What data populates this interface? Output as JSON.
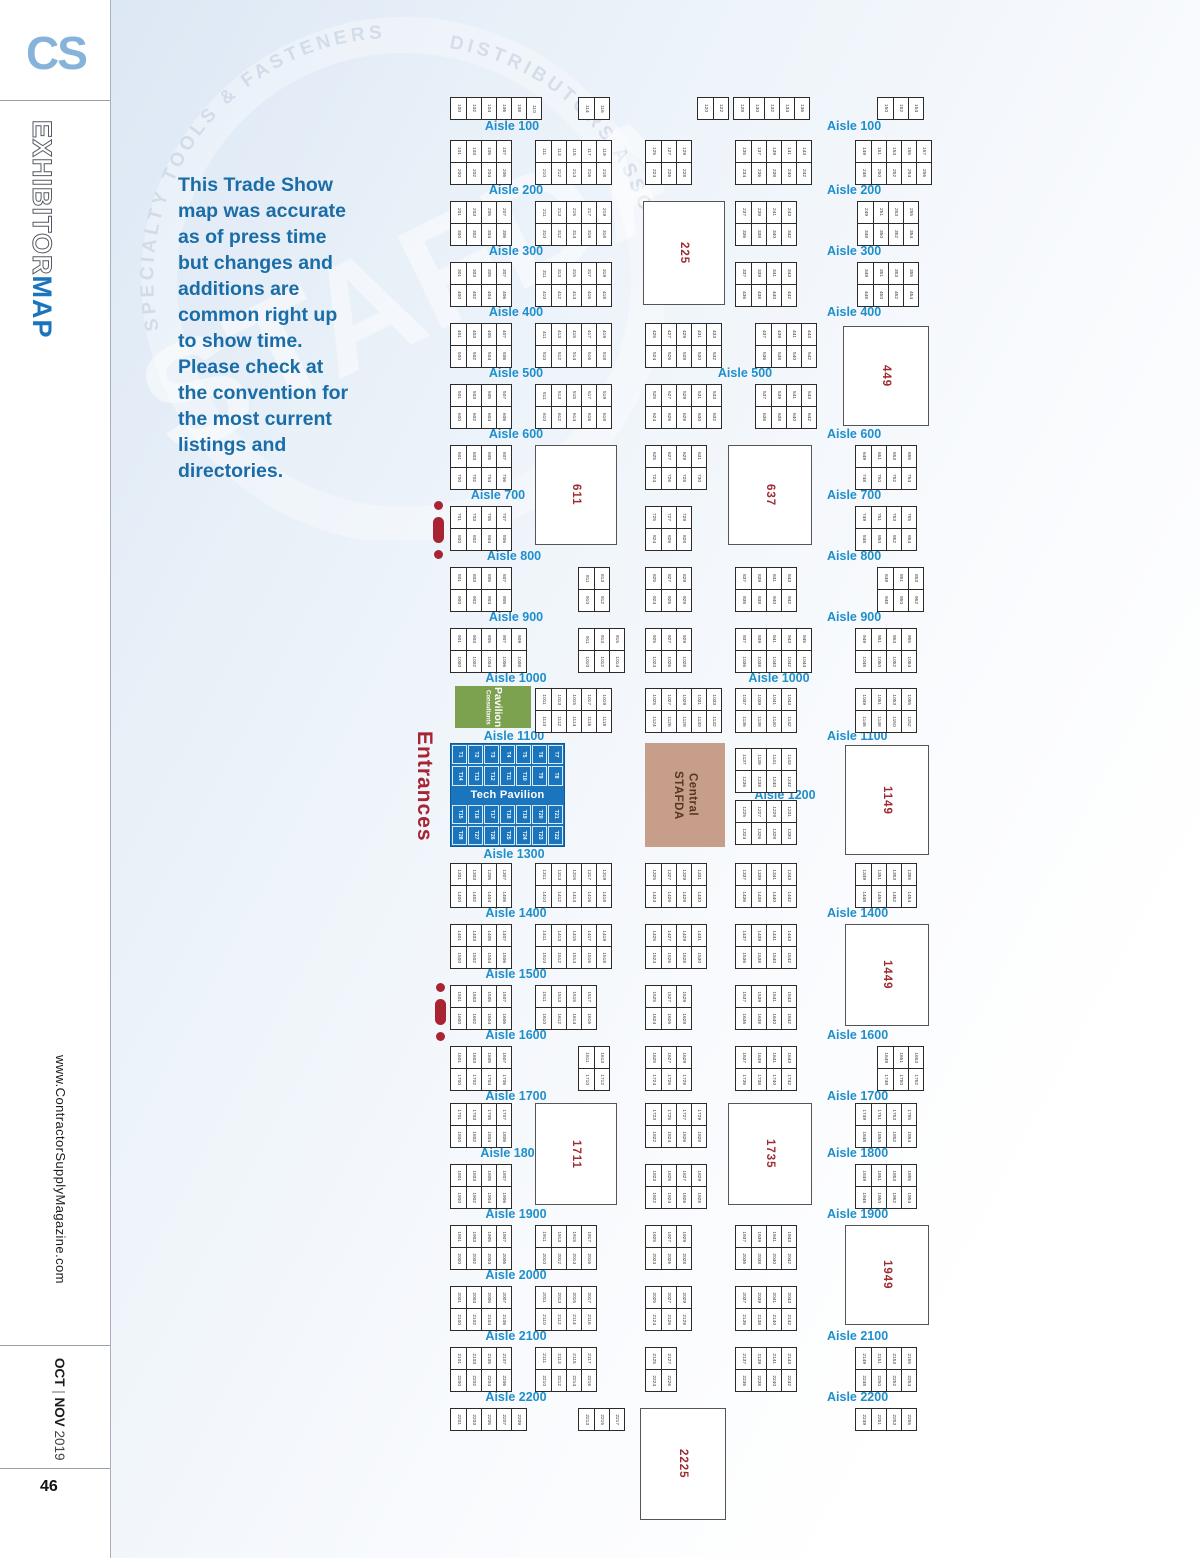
{
  "sidebar": {
    "logo": "CS",
    "masthead_light": "EXHIBITOR",
    "masthead_bold": "MAP",
    "website": "www.ContractorSupplyMagazine.com",
    "issue_month1": "OCT",
    "issue_sep": " | ",
    "issue_month2": "NOV",
    "issue_year": " 2019",
    "page_number": "46"
  },
  "intro": "This Trade Show\nmap was accurate\nas of press time\nbut changes and\nadditions are\ncommon right up\nto show time.\nPlease check at\nthe convention for\nthe most current\nlistings and\ndirectories.",
  "watermark": {
    "arc_left": "SPECIALTY TOOLS & FASTENERS",
    "arc_right": "DISTRIBUTORS ASSOCIATION",
    "ghost": "STAFDA"
  },
  "colors": {
    "aisle_label": "#1e8fcc",
    "booth_number_red": "#9e2b30",
    "entrance_red": "#a82433",
    "tech_blue": "#1a75bc",
    "pavilion_green": "#7ca24f",
    "stafda_tan": "#c79e8a",
    "intro_blue": "#1a6da7",
    "logo_blue": "#85b3da"
  },
  "map": {
    "entrances": "Entrances",
    "zones": {
      "consultants": {
        "line1": "Consultants",
        "line2": "Pavilion"
      },
      "stafda": {
        "line1": "STAFDA",
        "line2": "Central"
      },
      "tech": {
        "title": "Tech Pavilion",
        "rows": [
          [
            "T1",
            "T2",
            "T3",
            "T4",
            "T5",
            "T6",
            "T7"
          ],
          [
            "T14",
            "T13",
            "T12",
            "T11",
            "T10",
            "T9",
            "T8"
          ],
          [
            "T15",
            "T16",
            "T17",
            "T18",
            "T19",
            "T20",
            "T21"
          ],
          [
            "T28",
            "T27",
            "T26",
            "T25",
            "T24",
            "T23",
            "T22"
          ]
        ]
      }
    },
    "labels": [
      {
        "t": "Aisle 100",
        "x": 512,
        "y": 119,
        "a": "c"
      },
      {
        "t": "Aisle 200",
        "x": 516,
        "y": 183,
        "a": "c"
      },
      {
        "t": "Aisle 300",
        "x": 516,
        "y": 244,
        "a": "c"
      },
      {
        "t": "Aisle 400",
        "x": 516,
        "y": 305,
        "a": "c"
      },
      {
        "t": "Aisle 500",
        "x": 516,
        "y": 366,
        "a": "c"
      },
      {
        "t": "Aisle 600",
        "x": 516,
        "y": 427,
        "a": "c"
      },
      {
        "t": "Aisle 700",
        "x": 498,
        "y": 488,
        "a": "c"
      },
      {
        "t": "Aisle 800",
        "x": 514,
        "y": 549,
        "a": "c"
      },
      {
        "t": "Aisle 900",
        "x": 516,
        "y": 610,
        "a": "c"
      },
      {
        "t": "Aisle 1000",
        "x": 516,
        "y": 671,
        "a": "c"
      },
      {
        "t": "Aisle 1100",
        "x": 514,
        "y": 729,
        "a": "c"
      },
      {
        "t": "Aisle 1300",
        "x": 514,
        "y": 847,
        "a": "c"
      },
      {
        "t": "Aisle 1400",
        "x": 516,
        "y": 906,
        "a": "c"
      },
      {
        "t": "Aisle 1500",
        "x": 516,
        "y": 967,
        "a": "c"
      },
      {
        "t": "Aisle 1600",
        "x": 516,
        "y": 1028,
        "a": "c"
      },
      {
        "t": "Aisle 1700",
        "x": 516,
        "y": 1089,
        "a": "c"
      },
      {
        "t": "Aisle 1800",
        "x": 511,
        "y": 1146,
        "a": "c"
      },
      {
        "t": "Aisle 1900",
        "x": 516,
        "y": 1207,
        "a": "c"
      },
      {
        "t": "Aisle 2000",
        "x": 516,
        "y": 1268,
        "a": "c"
      },
      {
        "t": "Aisle 2100",
        "x": 516,
        "y": 1329,
        "a": "c"
      },
      {
        "t": "Aisle 2200",
        "x": 516,
        "y": 1390,
        "a": "c"
      },
      {
        "t": "Aisle 500",
        "x": 745,
        "y": 366,
        "a": "c"
      },
      {
        "t": "Aisle 1000",
        "x": 779,
        "y": 671,
        "a": "c"
      },
      {
        "t": "Aisle 1200",
        "x": 785,
        "y": 788,
        "a": "c"
      },
      {
        "t": "Aisle 100",
        "x": 827,
        "y": 119,
        "a": "l"
      },
      {
        "t": "Aisle 200",
        "x": 827,
        "y": 183,
        "a": "l"
      },
      {
        "t": "Aisle 300",
        "x": 827,
        "y": 244,
        "a": "l"
      },
      {
        "t": "Aisle 400",
        "x": 827,
        "y": 305,
        "a": "l"
      },
      {
        "t": "Aisle 600",
        "x": 827,
        "y": 427,
        "a": "l"
      },
      {
        "t": "Aisle 700",
        "x": 827,
        "y": 488,
        "a": "l"
      },
      {
        "t": "Aisle 800",
        "x": 827,
        "y": 549,
        "a": "l"
      },
      {
        "t": "Aisle 900",
        "x": 827,
        "y": 610,
        "a": "l"
      },
      {
        "t": "Aisle 1100",
        "x": 827,
        "y": 729,
        "a": "l"
      },
      {
        "t": "Aisle 1400",
        "x": 827,
        "y": 906,
        "a": "l"
      },
      {
        "t": "Aisle 1600",
        "x": 827,
        "y": 1028,
        "a": "l"
      },
      {
        "t": "Aisle 1700",
        "x": 827,
        "y": 1089,
        "a": "l"
      },
      {
        "t": "Aisle 1800",
        "x": 827,
        "y": 1146,
        "a": "l"
      },
      {
        "t": "Aisle 1900",
        "x": 827,
        "y": 1207,
        "a": "l"
      },
      {
        "t": "Aisle 2100",
        "x": 827,
        "y": 1329,
        "a": "l"
      },
      {
        "t": "Aisle 2200",
        "x": 827,
        "y": 1390,
        "a": "l"
      }
    ],
    "big_booths": [
      {
        "n": "225",
        "x": 643,
        "y": 201,
        "w": 82,
        "h": 104
      },
      {
        "n": "449",
        "x": 843,
        "y": 326,
        "w": 86,
        "h": 100
      },
      {
        "n": "611",
        "x": 535,
        "y": 445,
        "w": 82,
        "h": 100
      },
      {
        "n": "637",
        "x": 728,
        "y": 445,
        "w": 84,
        "h": 100
      },
      {
        "n": "1149",
        "x": 845,
        "y": 745,
        "w": 84,
        "h": 110
      },
      {
        "n": "1449",
        "x": 845,
        "y": 924,
        "w": 84,
        "h": 102
      },
      {
        "n": "1711",
        "x": 535,
        "y": 1103,
        "w": 82,
        "h": 102
      },
      {
        "n": "1735",
        "x": 728,
        "y": 1103,
        "w": 84,
        "h": 102
      },
      {
        "n": "1949",
        "x": 845,
        "y": 1225,
        "w": 84,
        "h": 100
      },
      {
        "n": "2225",
        "x": 640,
        "y": 1408,
        "w": 86,
        "h": 112
      }
    ],
    "strips": [
      {
        "y": 97,
        "blocks": [
          {
            "x": 450,
            "c": 6,
            "s": 100
          },
          {
            "x": 578,
            "c": 2,
            "s": 114
          },
          {
            "x": 697,
            "c": 2,
            "s": 120
          },
          {
            "x": 733,
            "c": 5,
            "s": 128
          },
          {
            "x": 877,
            "c": 3,
            "s": 150
          }
        ]
      },
      {
        "y": 140,
        "blocks": [
          {
            "x": 450,
            "c": 4,
            "t": 101,
            "b": 200
          },
          {
            "x": 535,
            "c": 5,
            "t": 111,
            "b": 210
          },
          {
            "x": 645,
            "c": 3,
            "t": 125,
            "b": 224
          },
          {
            "x": 735,
            "c": 5,
            "t": 135,
            "b": 234
          },
          {
            "x": 855,
            "c": 5,
            "t": 149,
            "b": 248
          }
        ]
      },
      {
        "y": 201,
        "blocks": [
          {
            "x": 450,
            "c": 4,
            "t": 201,
            "b": 300
          },
          {
            "x": 535,
            "c": 5,
            "t": 211,
            "b": 310
          },
          {
            "x": 735,
            "c": 4,
            "t": 237,
            "b": 336
          },
          {
            "x": 857,
            "c": 4,
            "t": 249,
            "b": 348
          }
        ]
      },
      {
        "y": 262,
        "blocks": [
          {
            "x": 450,
            "c": 4,
            "t": 301,
            "b": 400
          },
          {
            "x": 535,
            "c": 5,
            "t": 311,
            "b": 410
          },
          {
            "x": 735,
            "c": 4,
            "t": 337,
            "b": 436
          },
          {
            "x": 857,
            "c": 4,
            "t": 349,
            "b": 448
          }
        ]
      },
      {
        "y": 323,
        "blocks": [
          {
            "x": 450,
            "c": 4,
            "t": 401,
            "b": 500
          },
          {
            "x": 535,
            "c": 5,
            "t": 411,
            "b": 510
          },
          {
            "x": 645,
            "c": 5,
            "t": 425,
            "b": 524
          },
          {
            "x": 755,
            "c": 4,
            "t": 437,
            "b": 536
          }
        ]
      },
      {
        "y": 384,
        "blocks": [
          {
            "x": 450,
            "c": 4,
            "t": 501,
            "b": 600
          },
          {
            "x": 535,
            "c": 5,
            "t": 511,
            "b": 610
          },
          {
            "x": 645,
            "c": 5,
            "t": 525,
            "b": 624
          },
          {
            "x": 755,
            "c": 4,
            "t": 537,
            "b": 636
          }
        ]
      },
      {
        "y": 445,
        "blocks": [
          {
            "x": 450,
            "c": 4,
            "t": 601,
            "b": 700
          },
          {
            "x": 645,
            "c": 4,
            "t": 625,
            "b": 724
          },
          {
            "x": 855,
            "c": 4,
            "t": 649,
            "b": 748
          }
        ]
      },
      {
        "y": 506,
        "blocks": [
          {
            "x": 450,
            "c": 4,
            "t": 701,
            "b": 800
          },
          {
            "x": 645,
            "c": 3,
            "t": 725,
            "b": 824
          },
          {
            "x": 855,
            "c": 4,
            "t": 749,
            "b": 848
          }
        ]
      },
      {
        "y": 567,
        "blocks": [
          {
            "x": 450,
            "c": 4,
            "t": 801,
            "b": 900
          },
          {
            "x": 578,
            "c": 2,
            "t": 811,
            "b": 910
          },
          {
            "x": 645,
            "c": 3,
            "t": 825,
            "b": 924
          },
          {
            "x": 735,
            "c": 4,
            "t": 837,
            "b": 936
          },
          {
            "x": 877,
            "c": 3,
            "t": 849,
            "b": 948
          }
        ]
      },
      {
        "y": 628,
        "blocks": [
          {
            "x": 450,
            "c": 5,
            "t": 901,
            "b": 1000
          },
          {
            "x": 578,
            "c": 3,
            "t": 911,
            "b": 1010
          },
          {
            "x": 645,
            "c": 3,
            "t": 925,
            "b": 1024
          },
          {
            "x": 735,
            "c": 5,
            "t": 937,
            "b": 1036
          },
          {
            "x": 855,
            "c": 4,
            "t": 949,
            "b": 1048
          }
        ]
      },
      {
        "y": 688,
        "blocks": [
          {
            "x": 535,
            "c": 5,
            "t": 1011,
            "b": 1110
          },
          {
            "x": 645,
            "c": 5,
            "t": 1025,
            "b": 1124
          },
          {
            "x": 735,
            "c": 4,
            "t": 1037,
            "b": 1136
          },
          {
            "x": 855,
            "c": 4,
            "t": 1049,
            "b": 1146
          }
        ]
      },
      {
        "y": 748,
        "blocks": [
          {
            "x": 735,
            "c": 4,
            "t": 1137,
            "b": 1236
          }
        ]
      },
      {
        "y": 800,
        "blocks": [
          {
            "x": 735,
            "c": 4,
            "t": 1225,
            "b": 1324
          }
        ]
      },
      {
        "y": 863,
        "blocks": [
          {
            "x": 450,
            "c": 4,
            "t": 1301,
            "b": 1400
          },
          {
            "x": 535,
            "c": 5,
            "t": 1311,
            "b": 1410
          },
          {
            "x": 645,
            "c": 4,
            "t": 1325,
            "b": 1424
          },
          {
            "x": 735,
            "c": 4,
            "t": 1337,
            "b": 1436
          },
          {
            "x": 855,
            "c": 4,
            "t": 1349,
            "b": 1448
          }
        ]
      },
      {
        "y": 924,
        "blocks": [
          {
            "x": 450,
            "c": 4,
            "t": 1401,
            "b": 1500
          },
          {
            "x": 535,
            "c": 5,
            "t": 1411,
            "b": 1510
          },
          {
            "x": 645,
            "c": 4,
            "t": 1425,
            "b": 1524
          },
          {
            "x": 735,
            "c": 4,
            "t": 1437,
            "b": 1536
          }
        ]
      },
      {
        "y": 985,
        "blocks": [
          {
            "x": 450,
            "c": 4,
            "t": 1501,
            "b": 1600
          },
          {
            "x": 535,
            "c": 4,
            "t": 1511,
            "b": 1610
          },
          {
            "x": 645,
            "c": 3,
            "t": 1525,
            "b": 1624
          },
          {
            "x": 735,
            "c": 4,
            "t": 1537,
            "b": 1636
          }
        ]
      },
      {
        "y": 1046,
        "blocks": [
          {
            "x": 450,
            "c": 4,
            "t": 1601,
            "b": 1700
          },
          {
            "x": 578,
            "c": 2,
            "t": 1611,
            "b": 1710
          },
          {
            "x": 645,
            "c": 3,
            "t": 1625,
            "b": 1724
          },
          {
            "x": 735,
            "c": 4,
            "t": 1637,
            "b": 1736
          },
          {
            "x": 877,
            "c": 3,
            "t": 1649,
            "b": 1748
          }
        ]
      },
      {
        "y": 1103,
        "blocks": [
          {
            "x": 450,
            "c": 4,
            "t": 1701,
            "b": 1800
          },
          {
            "x": 645,
            "c": 4,
            "t": 1723,
            "b": 1822
          },
          {
            "x": 855,
            "c": 4,
            "t": 1749,
            "b": 1848
          }
        ]
      },
      {
        "y": 1164,
        "blocks": [
          {
            "x": 450,
            "c": 4,
            "t": 1801,
            "b": 1900
          },
          {
            "x": 645,
            "c": 4,
            "t": 1823,
            "b": 1922
          },
          {
            "x": 855,
            "c": 4,
            "t": 1849,
            "b": 1948
          }
        ]
      },
      {
        "y": 1225,
        "blocks": [
          {
            "x": 450,
            "c": 4,
            "t": 1901,
            "b": 2000
          },
          {
            "x": 535,
            "c": 4,
            "t": 1911,
            "b": 2010
          },
          {
            "x": 645,
            "c": 3,
            "t": 1925,
            "b": 2024
          },
          {
            "x": 735,
            "c": 4,
            "t": 1937,
            "b": 2036
          }
        ]
      },
      {
        "y": 1286,
        "blocks": [
          {
            "x": 450,
            "c": 4,
            "t": 2001,
            "b": 2100
          },
          {
            "x": 535,
            "c": 4,
            "t": 2011,
            "b": 2110
          },
          {
            "x": 645,
            "c": 3,
            "t": 2025,
            "b": 2124
          },
          {
            "x": 735,
            "c": 4,
            "t": 2037,
            "b": 2136
          }
        ]
      },
      {
        "y": 1347,
        "blocks": [
          {
            "x": 450,
            "c": 4,
            "t": 2101,
            "b": 2200
          },
          {
            "x": 535,
            "c": 4,
            "t": 2111,
            "b": 2210
          },
          {
            "x": 645,
            "c": 2,
            "t": 2125,
            "b": 2224
          },
          {
            "x": 735,
            "c": 4,
            "t": 2137,
            "b": 2236
          },
          {
            "x": 855,
            "c": 4,
            "t": 2149,
            "b": 2248
          }
        ]
      },
      {
        "y": 1408,
        "blocks": [
          {
            "x": 450,
            "c": 5,
            "s": 2201
          },
          {
            "x": 578,
            "c": 3,
            "s": 2213
          },
          {
            "x": 855,
            "c": 4,
            "s": 2249
          }
        ]
      }
    ],
    "entry_markers": [
      {
        "x": 431,
        "y": 501
      },
      {
        "x": 433,
        "y": 983
      }
    ]
  }
}
